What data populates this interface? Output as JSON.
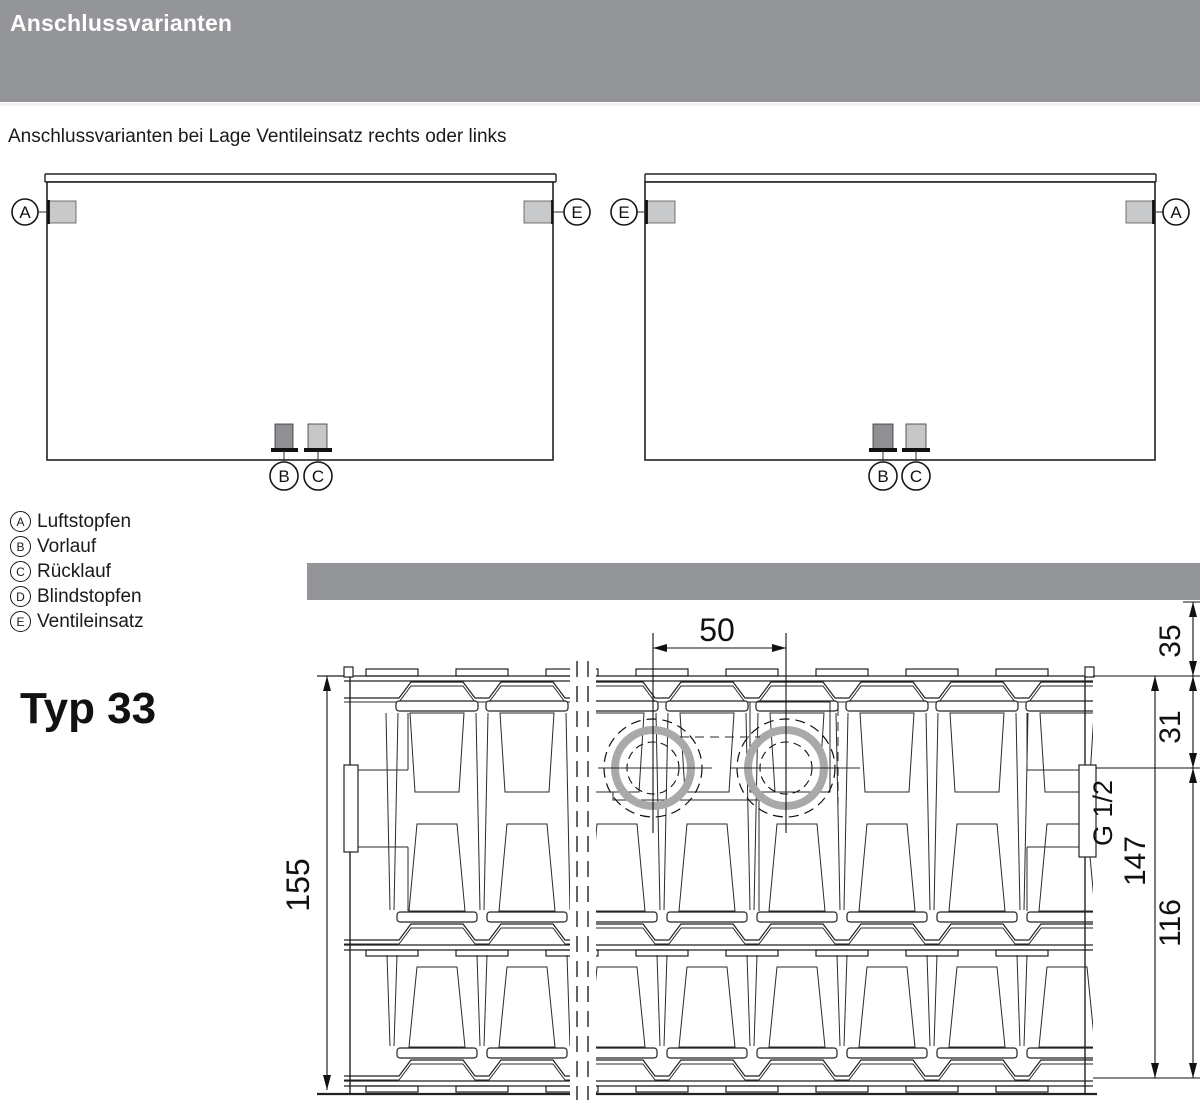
{
  "page": {
    "header_title": "Anschlussvarianten",
    "subtitle": "Anschlussvarianten bei Lage Ventileinsatz rechts oder links",
    "type_label": "Typ 33"
  },
  "legend": {
    "items": [
      {
        "key": "A",
        "label": "Luftstopfen"
      },
      {
        "key": "B",
        "label": "Vorlauf"
      },
      {
        "key": "C",
        "label": "Rücklauf"
      },
      {
        "key": "D",
        "label": "Blindstopfen"
      },
      {
        "key": "E",
        "label": "Ventileinsatz"
      }
    ]
  },
  "diagram_left": {
    "top_left": "A",
    "top_right": "E",
    "bottom_left": "B",
    "bottom_right": "C"
  },
  "diagram_right": {
    "top_left": "E",
    "top_right": "A",
    "bottom_left": "B",
    "bottom_right": "C"
  },
  "drawing": {
    "dim_tapping_spacing": "50",
    "dim_depth": "155",
    "dim_wall_to_top": "35",
    "dim_top_to_center": "31",
    "dim_thread": "G 1/2",
    "dim_total_from_top": "147",
    "dim_center_to_bottom": "116"
  },
  "colors": {
    "bar_gray": "#939598",
    "plug_light": "#c8c9cb",
    "plug_dark": "#8e9093",
    "ring_gray": "#a9a9a9",
    "line": "#222222"
  }
}
